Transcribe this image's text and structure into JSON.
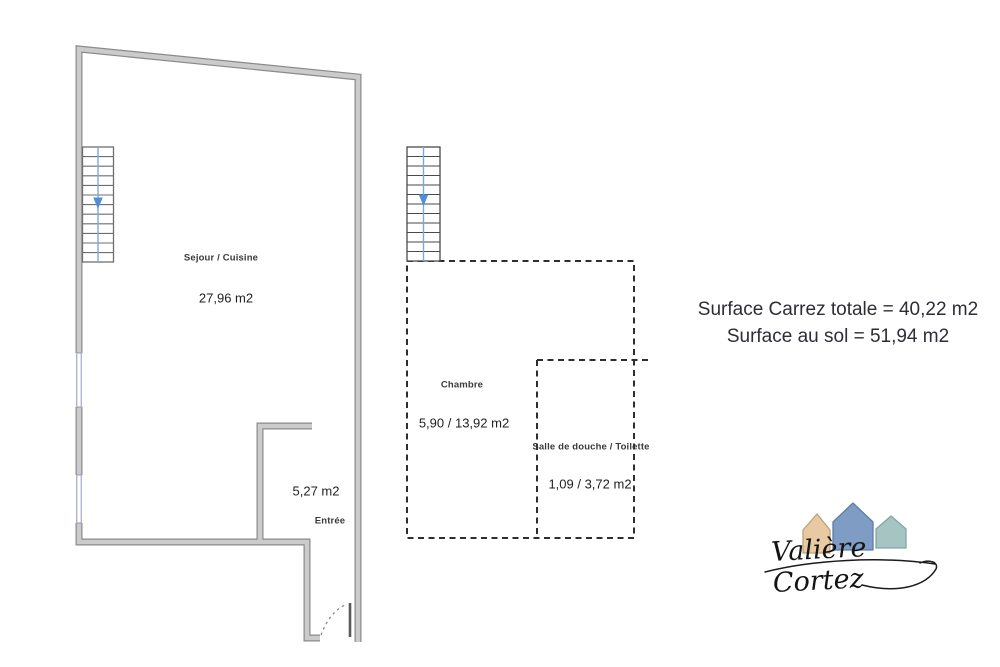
{
  "left_plan": {
    "rooms": [
      {
        "name": "Sejour / Cuisine",
        "area": "27,96 m2"
      },
      {
        "name": "Entrée",
        "area": "5,27 m2"
      }
    ]
  },
  "middle_plan": {
    "rooms": [
      {
        "name": "Chambre",
        "area": "5,90 / 13,92 m2"
      },
      {
        "name": "Salle de douche / Toilette",
        "area": "1,09 / 3,72 m2"
      }
    ]
  },
  "summary": {
    "line1": "Surface Carrez totale = 40,22 m2",
    "line2": "Surface au sol = 51,94 m2"
  },
  "logo": {
    "name": "Valière Cortez",
    "houses": [
      {
        "id": "left-house",
        "color": "#e7c9a2"
      },
      {
        "id": "middle-house",
        "color": "#7f9dc4"
      },
      {
        "id": "right-house",
        "color": "#a6c5c2"
      }
    ]
  },
  "colors": {
    "wall_fill": "#cbcbcb",
    "wall_outline": "#8a8a8a",
    "dashed_line": "#2e2e2e",
    "stair_blue": "#4f8fd9",
    "window_line": "#9296c2",
    "summary_text": "#2d2d35"
  }
}
